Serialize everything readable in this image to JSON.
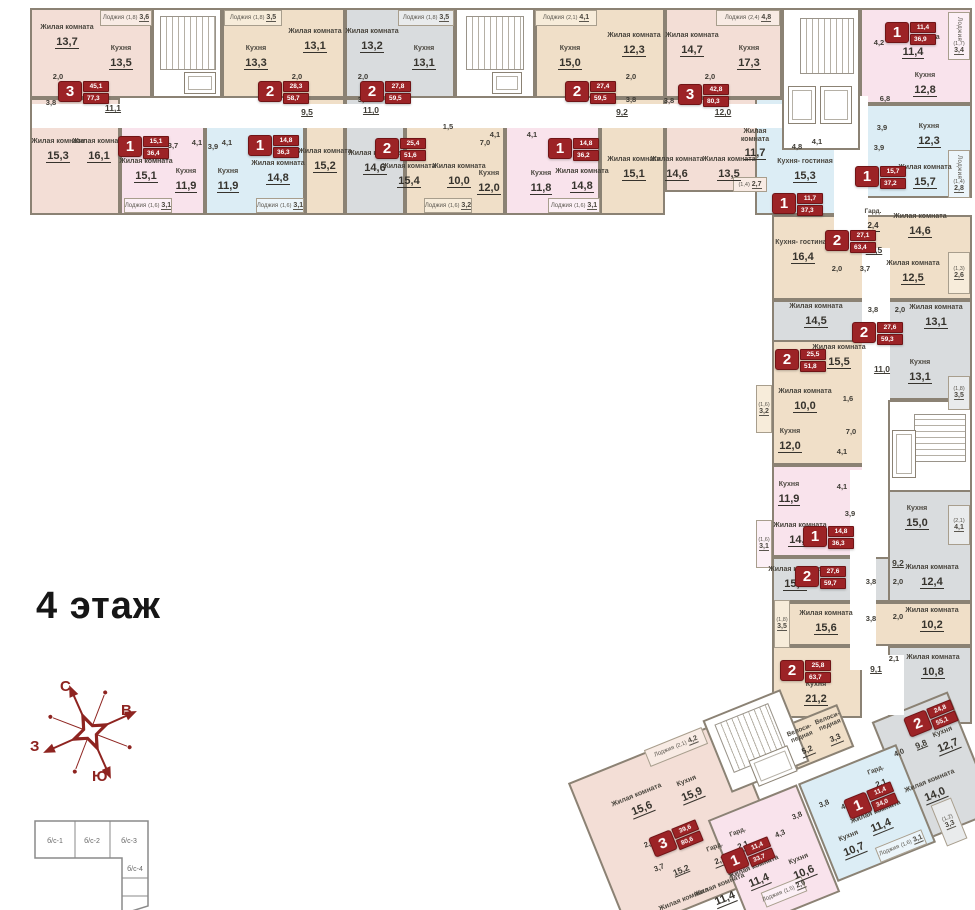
{
  "title": "4 этаж",
  "compass": {
    "north": "С",
    "east": "В",
    "west": "З",
    "south": "Ю"
  },
  "keyplan": {
    "sections": [
      "б/с-1",
      "б/с-2",
      "б/с-3",
      "б/с-4"
    ]
  },
  "colors": {
    "badge_red": "#9c2326",
    "rose": "#f3ded6",
    "beige": "#f0dfc8",
    "pink": "#f9e3ec",
    "blue": "#dcedf5",
    "gray": "#d9dcde",
    "wall": "#8b8274",
    "compass": "#8e2420"
  },
  "apts": [
    {
      "k": "3",
      "l": "45,1",
      "t": "77,3"
    },
    {
      "k": "1",
      "l": "15,1",
      "t": "36,4"
    },
    {
      "k": "1",
      "l": "14,8",
      "t": "36,3"
    },
    {
      "k": "2",
      "l": "28,3",
      "t": "58,7"
    },
    {
      "k": "2",
      "l": "27,8",
      "t": "59,5"
    },
    {
      "k": "2",
      "l": "25,4",
      "t": "51,6"
    },
    {
      "k": "1",
      "l": "14,8",
      "t": "36,2"
    },
    {
      "k": "2",
      "l": "27,4",
      "t": "59,5"
    },
    {
      "k": "3",
      "l": "42,8",
      "t": "80,3"
    },
    {
      "k": "1",
      "l": "11,4",
      "t": "36,9"
    },
    {
      "k": "1",
      "l": "15,7",
      "t": "37,2"
    },
    {
      "k": "1",
      "l": "11,7",
      "t": "37,3"
    },
    {
      "k": "2",
      "l": "27,1",
      "t": "63,4"
    },
    {
      "k": "2",
      "l": "27,6",
      "t": "59,3"
    },
    {
      "k": "2",
      "l": "25,5",
      "t": "51,8"
    },
    {
      "k": "1",
      "l": "14,8",
      "t": "36,3"
    },
    {
      "k": "2",
      "l": "27,6",
      "t": "59,7"
    },
    {
      "k": "2",
      "l": "25,8",
      "t": "63,7"
    },
    {
      "k": "2",
      "l": "24,8",
      "t": "55,1"
    },
    {
      "k": "3",
      "l": "39,6",
      "t": "80,6"
    },
    {
      "k": "1",
      "l": "11,4",
      "t": "33,7"
    },
    {
      "k": "1",
      "l": "11,4",
      "t": "34,0"
    }
  ],
  "rooms": [
    {
      "n": "Жилая комната",
      "a": "13,7"
    },
    {
      "n": "Кухня",
      "a": "13,5"
    },
    {
      "n": "Жилая комната",
      "a": "15,3"
    },
    {
      "n": "Жилая комната",
      "a": "16,1"
    },
    {
      "n": "Жилая комната",
      "a": "15,1"
    },
    {
      "n": "Кухня",
      "a": "11,9"
    },
    {
      "n": "Кухня",
      "a": "11,9"
    },
    {
      "n": "Жилая комната",
      "a": "14,8"
    },
    {
      "n": "Кухня",
      "a": "13,3"
    },
    {
      "n": "Жилая комната",
      "a": "13,1"
    },
    {
      "n": "Жилая комната",
      "a": "15,2"
    },
    {
      "n": "Жилая комната",
      "a": "13,2"
    },
    {
      "n": "Кухня",
      "a": "13,1"
    },
    {
      "n": "Жилая комната",
      "a": "14,6"
    },
    {
      "n": "Жилая комната",
      "a": "15,4"
    },
    {
      "n": "Жилая комната",
      "a": "10,0"
    },
    {
      "n": "Кухня",
      "a": "12,0"
    },
    {
      "n": "Кухня",
      "a": "11,8"
    },
    {
      "n": "Жилая комната",
      "a": "14,8"
    },
    {
      "n": "Кухня",
      "a": "15,0"
    },
    {
      "n": "Жилая комната",
      "a": "12,3"
    },
    {
      "n": "Жилая комната",
      "a": "15,1"
    },
    {
      "n": "Жилая комната",
      "a": "14,7"
    },
    {
      "n": "Кухня",
      "a": "17,3"
    },
    {
      "n": "Жилая комната",
      "a": "14,6"
    },
    {
      "n": "Жилая комната",
      "a": "13,5"
    },
    {
      "n": "Жилая комната",
      "a": "11,4"
    },
    {
      "n": "Кухня",
      "a": "12,8"
    },
    {
      "n": "Кухня",
      "a": "12,3"
    },
    {
      "n": "Жилая комната",
      "a": "15,7"
    },
    {
      "n": "Жилая комната",
      "a": "11,7"
    },
    {
      "n": "Кухня- гостиная",
      "a": "15,3"
    },
    {
      "n": "Кухня- гостиная",
      "a": "16,4"
    },
    {
      "n": "Гард.",
      "a": "2,4"
    },
    {
      "n": "Жилая комната",
      "a": "14,6"
    },
    {
      "n": "Жилая комната",
      "a": "12,5"
    },
    {
      "n": "Жилая комната",
      "a": "14,5"
    },
    {
      "n": "Жилая комната",
      "a": "13,1"
    },
    {
      "n": "Кухня",
      "a": "13,1"
    },
    {
      "n": "Жилая комната",
      "a": "15,5"
    },
    {
      "n": "Жилая комната",
      "a": "10,0"
    },
    {
      "n": "Кухня",
      "a": "12,0"
    },
    {
      "n": "Кухня",
      "a": "11,9"
    },
    {
      "n": "Жилая комната",
      "a": "14,8"
    },
    {
      "n": "Жилая комната",
      "a": "15,2"
    },
    {
      "n": "Кухня",
      "a": "15,0"
    },
    {
      "n": "Жилая комната",
      "a": "12,4"
    },
    {
      "n": "Жилая комната",
      "a": "15,6"
    },
    {
      "n": "Жилая комната",
      "a": "10,2"
    },
    {
      "n": "Кухня",
      "a": "21,2"
    },
    {
      "n": "Жилая комната",
      "a": "10,8"
    },
    {
      "n": "Кухня",
      "a": "12,7"
    },
    {
      "n": "Жилая комната",
      "a": "14,0"
    },
    {
      "n": "Жилая комната",
      "a": "15,6"
    },
    {
      "n": "Кухня",
      "a": "15,9"
    },
    {
      "n": "Жилая комната",
      "a": "11,4"
    },
    {
      "n": "Жилая комната",
      "a": ""
    },
    {
      "n": "Жилая комната",
      "a": "11,4"
    },
    {
      "n": "Кухня",
      "a": "10,6"
    },
    {
      "n": "Жилая комната",
      "a": "11,4"
    },
    {
      "n": "Кухня",
      "a": "10,7"
    },
    {
      "n": "Велоси- педная",
      "a": "5,2"
    },
    {
      "n": "Велоси- педная",
      "a": "3,3"
    },
    {
      "n": "Гард.",
      "a": "2,1"
    },
    {
      "n": "Гард.",
      "a": "2,1"
    },
    {
      "n": "Гард.",
      "a": "2,1"
    }
  ],
  "lodjias": [
    {
      "n": "Лоджия",
      "c": "(1,8)",
      "a": "3,6"
    },
    {
      "n": "Лоджия",
      "c": "(1,8)",
      "a": "3,5"
    },
    {
      "n": "Лоджия",
      "c": "(1,8)",
      "a": "3,5"
    },
    {
      "n": "Лоджия",
      "c": "(2,1)",
      "a": "4,1"
    },
    {
      "n": "Лоджия",
      "c": "(2,4)",
      "a": "4,8"
    },
    {
      "n": "Лоджия",
      "c": "(1,6)",
      "a": "3,1"
    },
    {
      "n": "Лоджия",
      "c": "(1,6)",
      "a": "3,1"
    },
    {
      "n": "Лоджия",
      "c": "(1,6)",
      "a": "3,2"
    },
    {
      "n": "Лоджия",
      "c": "(1,6)",
      "a": "3,1"
    },
    {
      "n": "Лоджия",
      "c": "(1,4)",
      "a": "2,7"
    },
    {
      "n": "Лоджия",
      "c": "(1,7)",
      "a": "3,4"
    },
    {
      "n": "Лоджия",
      "c": "(1,4)",
      "a": "2,8"
    },
    {
      "n": "Лоджия",
      "c": "(1,3)",
      "a": "2,6"
    },
    {
      "n": "Лоджия",
      "c": "(1,8)",
      "a": "3,5"
    },
    {
      "n": "Лоджия",
      "c": "(1,6)",
      "a": "3,2"
    },
    {
      "n": "Лоджия",
      "c": "(1,6)",
      "a": "3,1"
    },
    {
      "n": "Лоджия",
      "c": "(2,1)",
      "a": "4,1"
    },
    {
      "n": "Лоджия",
      "c": "(1,8)",
      "a": "3,5"
    },
    {
      "n": "Лоджия",
      "c": "(1,2)",
      "a": "3,3"
    },
    {
      "n": "Лоджия",
      "c": "(2,1)",
      "a": "4,2"
    },
    {
      "n": "Лоджия",
      "c": "(1,5)",
      "a": "2,9"
    },
    {
      "n": "Лоджия",
      "c": "(1,6)",
      "a": "3,1"
    }
  ],
  "nums": [
    "2,0",
    "3,8",
    "11,1",
    "3,7",
    "4,1",
    "3,9",
    "4,1",
    "2,0",
    "3,8",
    "9,5",
    "2,0",
    "3,8",
    "11,0",
    "1,5",
    "4,1",
    "7,0",
    "4,1",
    "3,9",
    "2,0",
    "3,8",
    "9,2",
    "2,0",
    "3,8",
    "12,0",
    "4,2",
    "6,8",
    "3,9",
    "3,9",
    "4,8",
    "4,1",
    "10,5",
    "2,0",
    "3,7",
    "3,8",
    "2,0",
    "11,0",
    "1,6",
    "7,0",
    "4,1",
    "4,1",
    "3,9",
    "9,2",
    "3,8",
    "2,0",
    "3,8",
    "2,0",
    "9,1",
    "2,1",
    "9,8",
    "4,0",
    "2,0",
    "3,7",
    "15,2",
    "4,3",
    "3,8",
    "4,4",
    "3,8"
  ]
}
